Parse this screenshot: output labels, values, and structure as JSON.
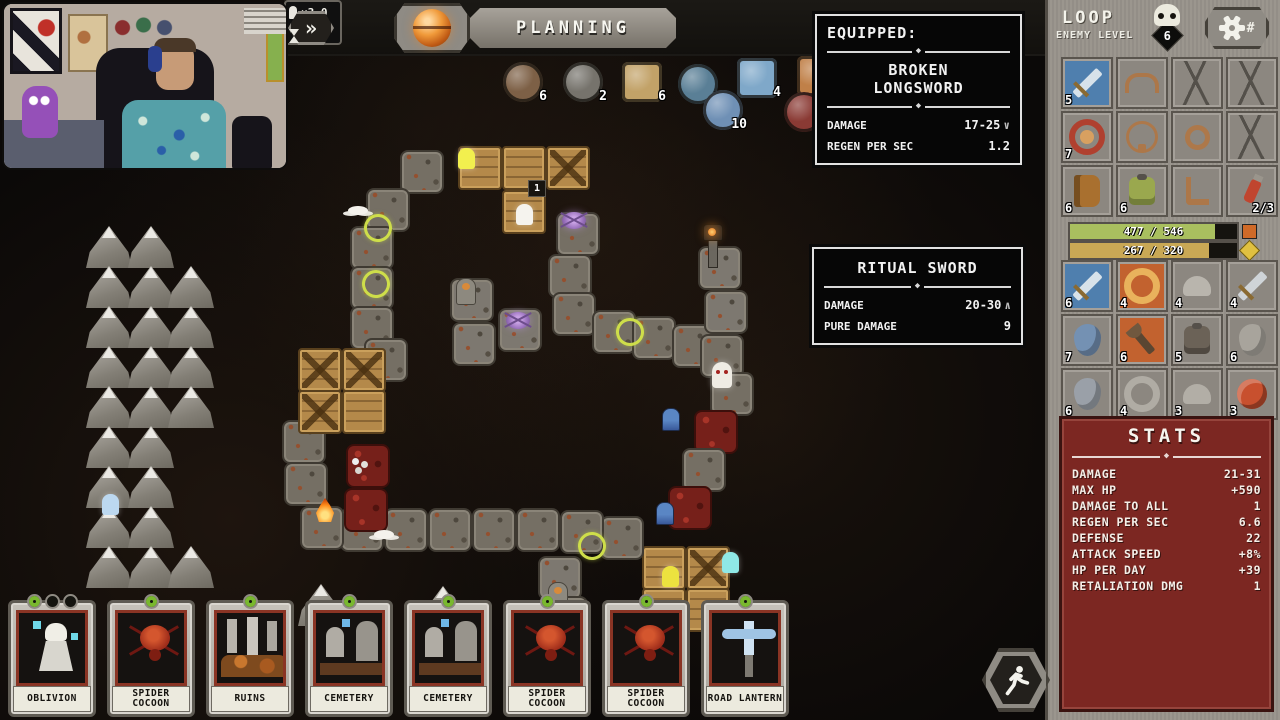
{
  "ornament": "◆",
  "webcam": {
    "label": "streamer-webcam"
  },
  "top_bar": {
    "fast_forward_label": "»",
    "phase_label": "PLANNING",
    "speed_rows": [
      {
        "icon": "pawn-icon",
        "value": "×3.0"
      },
      {
        "icon": "hourglass-icon",
        "value": "×2.5"
      }
    ]
  },
  "resources": [
    {
      "name": "rock",
      "count": "6",
      "x": 503,
      "y": 62,
      "shape": "round",
      "color": "#7d6046"
    },
    {
      "name": "branch",
      "count": "2",
      "x": 563,
      "y": 62,
      "shape": "round",
      "color": "#76736c"
    },
    {
      "name": "sand",
      "count": "6",
      "x": 622,
      "y": 62,
      "shape": "square",
      "color": "#c2a268"
    },
    {
      "name": "orb",
      "count": "3",
      "x": 678,
      "y": 64,
      "shape": "round",
      "color": "#5a7f96"
    },
    {
      "name": "planet",
      "count": "4",
      "x": 737,
      "y": 58,
      "shape": "square",
      "color": "#7fa8c9"
    },
    {
      "name": "sphere",
      "count": "10",
      "x": 703,
      "y": 90,
      "shape": "round",
      "color": "#6f90b5"
    },
    {
      "name": "tile",
      "count": "2",
      "x": 797,
      "y": 56,
      "shape": "square",
      "color": "#c08048"
    },
    {
      "name": "claw",
      "count": "6",
      "x": 784,
      "y": 92,
      "shape": "round",
      "color": "#8a3a34"
    }
  ],
  "equipped_tooltip": {
    "title": "EQUIPPED:",
    "item_name": "BROKEN LONGSWORD",
    "rows": [
      {
        "label": "DAMAGE",
        "value": "17-25",
        "arrow": "∨"
      },
      {
        "label": "REGEN PER SEC",
        "value": "1.2",
        "arrow": ""
      }
    ]
  },
  "compare_tooltip": {
    "item_name": "RITUAL SWORD",
    "rows": [
      {
        "label": "DAMAGE",
        "value": "20-30",
        "arrow": "∧"
      },
      {
        "label": "PURE DAMAGE",
        "value": "9",
        "arrow": ""
      }
    ]
  },
  "sidebar": {
    "title": "LOOP",
    "subtitle": "ENEMY LEVEL",
    "enemy_level": "6",
    "equipment_slots": [
      {
        "state": "filled",
        "shape": "sword",
        "lvl": "5",
        "bg": "#4f7fae",
        "fg": "#d7e2ea"
      },
      {
        "state": "ghost",
        "shape": "helmet"
      },
      {
        "state": "cracked"
      },
      {
        "state": "cracked"
      },
      {
        "state": "filled",
        "shape": "amulet",
        "lvl": "7",
        "bg": "#8c8780",
        "fg": "#b0402f"
      },
      {
        "state": "ghost",
        "shape": "necklace"
      },
      {
        "state": "ghost",
        "shape": "ring"
      },
      {
        "state": "cracked"
      },
      {
        "state": "filled",
        "shape": "book",
        "lvl": "6",
        "bg": "#8c8780",
        "fg": "#a9702f"
      },
      {
        "state": "filled",
        "shape": "armor",
        "lvl": "6",
        "bg": "#8c8780",
        "fg": "#9aa84e"
      },
      {
        "state": "ghost",
        "shape": "boot"
      },
      {
        "state": "filled",
        "shape": "potion",
        "lvl": "2/3",
        "bg": "#8c8780",
        "fg": "#c0452f",
        "lvl_right": true
      }
    ],
    "hp_bar": {
      "value": "477 / 546",
      "fill": 0.87,
      "color": "#a9bf5f"
    },
    "xp_bar": {
      "value": "267 / 320",
      "fill": 0.83,
      "color": "#c9a855"
    },
    "loot_grid": [
      {
        "shape": "sword",
        "lvl": "6",
        "bg": "#4f7fae",
        "fg": "#d7e2ea"
      },
      {
        "shape": "ring",
        "lvl": "4",
        "bg": "#c2622f",
        "fg": "#e9b25c"
      },
      {
        "shape": "helmet",
        "lvl": "4",
        "bg": "#8c8780",
        "fg": "#b9b5ad"
      },
      {
        "shape": "sword",
        "lvl": "4",
        "bg": "#8c8780",
        "fg": "#cfd4d8"
      },
      {
        "shape": "shield",
        "lvl": "7",
        "bg": "#8c8780",
        "fg": "#7491b3"
      },
      {
        "shape": "axe",
        "lvl": "6",
        "bg": "#c2622f",
        "fg": "#5a4632"
      },
      {
        "shape": "armor",
        "lvl": "5",
        "bg": "#8c8780",
        "fg": "#6b6257"
      },
      {
        "shape": "shield",
        "lvl": "6",
        "bg": "#8c8780",
        "fg": "#a8a49c"
      },
      {
        "shape": "shield",
        "lvl": "6",
        "bg": "#8c8780",
        "fg": "#9aa0a8"
      },
      {
        "shape": "ring",
        "lvl": "4",
        "bg": "#8c8780",
        "fg": "#b0aca4"
      },
      {
        "shape": "helmet",
        "lvl": "3",
        "bg": "#8c8780",
        "fg": "#b2aea6"
      },
      {
        "shape": "roundshield",
        "lvl": "3",
        "bg": "#8c8780",
        "fg": "#c8502e"
      }
    ],
    "stats": {
      "title": "STATS",
      "rows": [
        [
          "DAMAGE",
          "21-31"
        ],
        [
          "MAX HP",
          "+590"
        ],
        [
          "DAMAGE TO ALL",
          "1"
        ],
        [
          "REGEN PER SEC",
          "6.6"
        ],
        [
          "DEFENSE",
          "22"
        ],
        [
          "ATTACK SPEED",
          "+8%"
        ],
        [
          "HP PER DAY",
          "+39"
        ],
        [
          "RETALIATION DMG",
          "1"
        ]
      ]
    }
  },
  "cards": [
    {
      "name": "OBLIVION",
      "art": "oblivion",
      "gems": 3
    },
    {
      "name": "SPIDER COCOON",
      "art": "spider",
      "gems": 1
    },
    {
      "name": "RUINS",
      "art": "ruins",
      "gems": 1
    },
    {
      "name": "CEMETERY",
      "art": "cemetery",
      "gems": 1
    },
    {
      "name": "CEMETERY",
      "art": "cemetery",
      "gems": 1
    },
    {
      "name": "SPIDER COCOON",
      "art": "spider",
      "gems": 1
    },
    {
      "name": "SPIDER COCOON",
      "art": "spider",
      "gems": 1
    },
    {
      "name": "ROAD LANTERN",
      "art": "lantern",
      "gems": 1
    }
  ],
  "map": {
    "tiles": [
      {
        "x": 400,
        "y": 150,
        "t": "p"
      },
      {
        "x": 366,
        "y": 188,
        "t": "p"
      },
      {
        "x": 350,
        "y": 226,
        "t": "p"
      },
      {
        "x": 350,
        "y": 266,
        "t": "p"
      },
      {
        "x": 350,
        "y": 306,
        "t": "p"
      },
      {
        "x": 364,
        "y": 338,
        "t": "p"
      },
      {
        "x": 458,
        "y": 146,
        "t": "w"
      },
      {
        "x": 502,
        "y": 146,
        "t": "w"
      },
      {
        "x": 546,
        "y": 146,
        "t": "c"
      },
      {
        "x": 502,
        "y": 190,
        "t": "w"
      },
      {
        "x": 556,
        "y": 212,
        "t": "p"
      },
      {
        "x": 548,
        "y": 254,
        "t": "p"
      },
      {
        "x": 552,
        "y": 292,
        "t": "p"
      },
      {
        "x": 592,
        "y": 310,
        "t": "p"
      },
      {
        "x": 632,
        "y": 316,
        "t": "p"
      },
      {
        "x": 672,
        "y": 324,
        "t": "p"
      },
      {
        "x": 700,
        "y": 334,
        "t": "p"
      },
      {
        "x": 698,
        "y": 246,
        "t": "g"
      },
      {
        "x": 704,
        "y": 290,
        "t": "g"
      },
      {
        "x": 710,
        "y": 372,
        "t": "p"
      },
      {
        "x": 694,
        "y": 410,
        "t": "b"
      },
      {
        "x": 682,
        "y": 448,
        "t": "p"
      },
      {
        "x": 668,
        "y": 486,
        "t": "b"
      },
      {
        "x": 642,
        "y": 546,
        "t": "w"
      },
      {
        "x": 686,
        "y": 546,
        "t": "c"
      },
      {
        "x": 642,
        "y": 588,
        "t": "w"
      },
      {
        "x": 686,
        "y": 588,
        "t": "w"
      },
      {
        "x": 600,
        "y": 516,
        "t": "p"
      },
      {
        "x": 560,
        "y": 510,
        "t": "p"
      },
      {
        "x": 516,
        "y": 508,
        "t": "p"
      },
      {
        "x": 472,
        "y": 508,
        "t": "p"
      },
      {
        "x": 428,
        "y": 508,
        "t": "p"
      },
      {
        "x": 384,
        "y": 508,
        "t": "p"
      },
      {
        "x": 340,
        "y": 508,
        "t": "p"
      },
      {
        "x": 300,
        "y": 506,
        "t": "p"
      },
      {
        "x": 284,
        "y": 462,
        "t": "p"
      },
      {
        "x": 282,
        "y": 420,
        "t": "p"
      },
      {
        "x": 298,
        "y": 348,
        "t": "c"
      },
      {
        "x": 342,
        "y": 348,
        "t": "c"
      },
      {
        "x": 298,
        "y": 390,
        "t": "c"
      },
      {
        "x": 342,
        "y": 390,
        "t": "w"
      },
      {
        "x": 346,
        "y": 444,
        "t": "b"
      },
      {
        "x": 344,
        "y": 488,
        "t": "b"
      },
      {
        "x": 450,
        "y": 278,
        "t": "g"
      },
      {
        "x": 452,
        "y": 322,
        "t": "g"
      },
      {
        "x": 498,
        "y": 308,
        "t": "g"
      },
      {
        "x": 538,
        "y": 556,
        "t": "g"
      },
      {
        "x": 544,
        "y": 596,
        "t": "g"
      },
      {
        "x": 86,
        "y": 226,
        "t": "m"
      },
      {
        "x": 128,
        "y": 226,
        "t": "m"
      },
      {
        "x": 86,
        "y": 266,
        "t": "m"
      },
      {
        "x": 128,
        "y": 266,
        "t": "m"
      },
      {
        "x": 168,
        "y": 266,
        "t": "m"
      },
      {
        "x": 86,
        "y": 306,
        "t": "m"
      },
      {
        "x": 128,
        "y": 306,
        "t": "m"
      },
      {
        "x": 168,
        "y": 306,
        "t": "m"
      },
      {
        "x": 86,
        "y": 346,
        "t": "m"
      },
      {
        "x": 128,
        "y": 346,
        "t": "m"
      },
      {
        "x": 168,
        "y": 346,
        "t": "m"
      },
      {
        "x": 86,
        "y": 386,
        "t": "m"
      },
      {
        "x": 128,
        "y": 386,
        "t": "m"
      },
      {
        "x": 168,
        "y": 386,
        "t": "m"
      },
      {
        "x": 86,
        "y": 426,
        "t": "m"
      },
      {
        "x": 128,
        "y": 426,
        "t": "m"
      },
      {
        "x": 86,
        "y": 466,
        "t": "m"
      },
      {
        "x": 128,
        "y": 466,
        "t": "m"
      },
      {
        "x": 86,
        "y": 506,
        "t": "m"
      },
      {
        "x": 128,
        "y": 506,
        "t": "m"
      },
      {
        "x": 86,
        "y": 546,
        "t": "m"
      },
      {
        "x": 128,
        "y": 546,
        "t": "m"
      },
      {
        "x": 168,
        "y": 546,
        "t": "m"
      },
      {
        "x": 298,
        "y": 584,
        "t": "m"
      },
      {
        "x": 420,
        "y": 586,
        "t": "m"
      }
    ],
    "entities": [
      {
        "t": "ghost",
        "c": "#f2ef4e",
        "x": 458,
        "y": 148,
        "name": "enemy-ghost-yellow"
      },
      {
        "t": "ghost",
        "c": "#f5f3ee",
        "x": 516,
        "y": 204,
        "name": "enemy-ghost-white"
      },
      {
        "t": "spider",
        "x": 562,
        "y": 212,
        "name": "enemy-spider"
      },
      {
        "t": "spider",
        "x": 506,
        "y": 312,
        "name": "enemy-spider"
      },
      {
        "t": "bat",
        "x": 348,
        "y": 206,
        "name": "enemy-bat"
      },
      {
        "t": "ring",
        "x": 364,
        "y": 214,
        "name": "buff-ring"
      },
      {
        "t": "ring",
        "x": 362,
        "y": 270,
        "name": "buff-ring"
      },
      {
        "t": "ring",
        "x": 616,
        "y": 318,
        "name": "buff-ring"
      },
      {
        "t": "ring",
        "x": 578,
        "y": 532,
        "name": "buff-ring"
      },
      {
        "t": "bat",
        "x": 374,
        "y": 530,
        "name": "enemy-bat"
      },
      {
        "t": "fire",
        "x": 316,
        "y": 498,
        "name": "campfire"
      },
      {
        "t": "lamp",
        "x": 702,
        "y": 224,
        "name": "road-lantern"
      },
      {
        "t": "monk",
        "x": 456,
        "y": 278,
        "name": "statue"
      },
      {
        "t": "monk",
        "x": 548,
        "y": 582,
        "name": "statue"
      },
      {
        "t": "vamp",
        "x": 712,
        "y": 362,
        "name": "enemy-vampire"
      },
      {
        "t": "hood",
        "x": 662,
        "y": 408,
        "name": "enemy-watcher"
      },
      {
        "t": "hood",
        "x": 656,
        "y": 502,
        "name": "enemy-watcher"
      },
      {
        "t": "ghost",
        "c": "#ece23f",
        "x": 662,
        "y": 566,
        "name": "enemy-ghost-yellow"
      },
      {
        "t": "ghost",
        "c": "#8fe8e6",
        "x": 722,
        "y": 552,
        "name": "enemy-ghost-cyan"
      },
      {
        "t": "ghost",
        "c": "#bcd8f0",
        "x": 102,
        "y": 494,
        "name": "enemy-ghost-blue"
      },
      {
        "t": "skullpile",
        "x": 352,
        "y": 458,
        "name": "blood-pile"
      },
      {
        "t": "badge",
        "v": "1",
        "x": 528,
        "y": 180,
        "name": "tile-counter"
      }
    ]
  }
}
